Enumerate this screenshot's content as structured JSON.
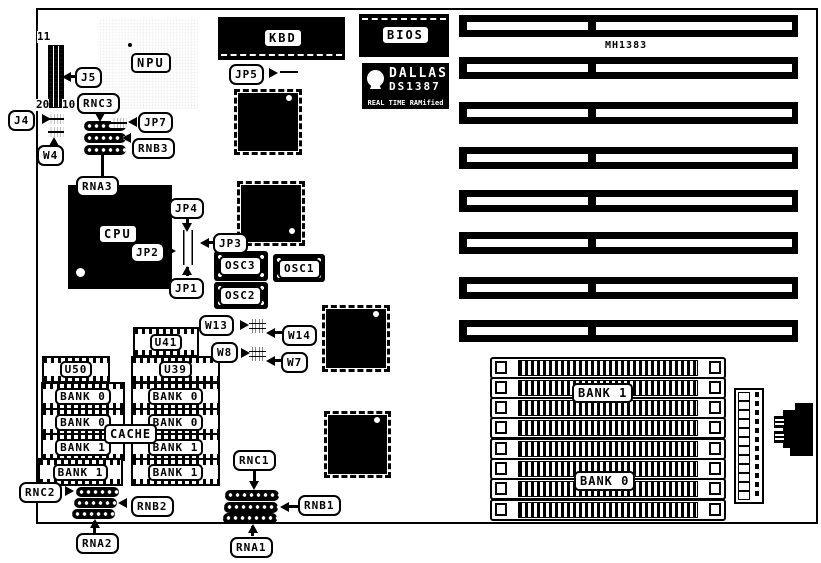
{
  "colors": {
    "ink": "#000000",
    "paper": "#ffffff"
  },
  "chips": {
    "npu": "NPU",
    "cpu": "CPU",
    "kbd": "KBD",
    "bios": "BIOS",
    "cache": "CACHE",
    "chipset": "MH1383",
    "osc1": "OSC1",
    "osc2": "OSC2",
    "osc3": "OSC3",
    "dallas": {
      "brand": "DALLAS",
      "part": "DS1387",
      "tagline": "REAL TIME RAMified"
    }
  },
  "callouts": {
    "j4": "J4",
    "j5": "J5",
    "w4": "W4",
    "w7": "W7",
    "w8": "W8",
    "w13": "W13",
    "w14": "W14",
    "jp1": "JP1",
    "jp2": "JP2",
    "jp3": "JP3",
    "jp4": "JP4",
    "jp5": "JP5",
    "jp7": "JP7",
    "rna1": "RNA1",
    "rnb1": "RNB1",
    "rnc1": "RNC1",
    "rna2": "RNA2",
    "rnb2": "RNB2",
    "rnc2": "RNC2",
    "rna3": "RNA3",
    "rnb3": "RNB3",
    "rnc3": "RNC3"
  },
  "pin_numbers": {
    "j5_top": "11",
    "j5_bottom_left": "20",
    "j5_bottom_right": "10"
  },
  "cache_chips": {
    "left": [
      "U50",
      "BANK 0",
      "BANK 0",
      "BANK 1",
      "BANK 1"
    ],
    "right": [
      "U41",
      "U39",
      "BANK 0",
      "BANK 0",
      "BANK 1",
      "BANK 1"
    ]
  },
  "simm": {
    "bank1": "BANK 1",
    "bank0": "BANK 0",
    "slot_count": 8
  },
  "isa": {
    "slot_count": 8
  }
}
